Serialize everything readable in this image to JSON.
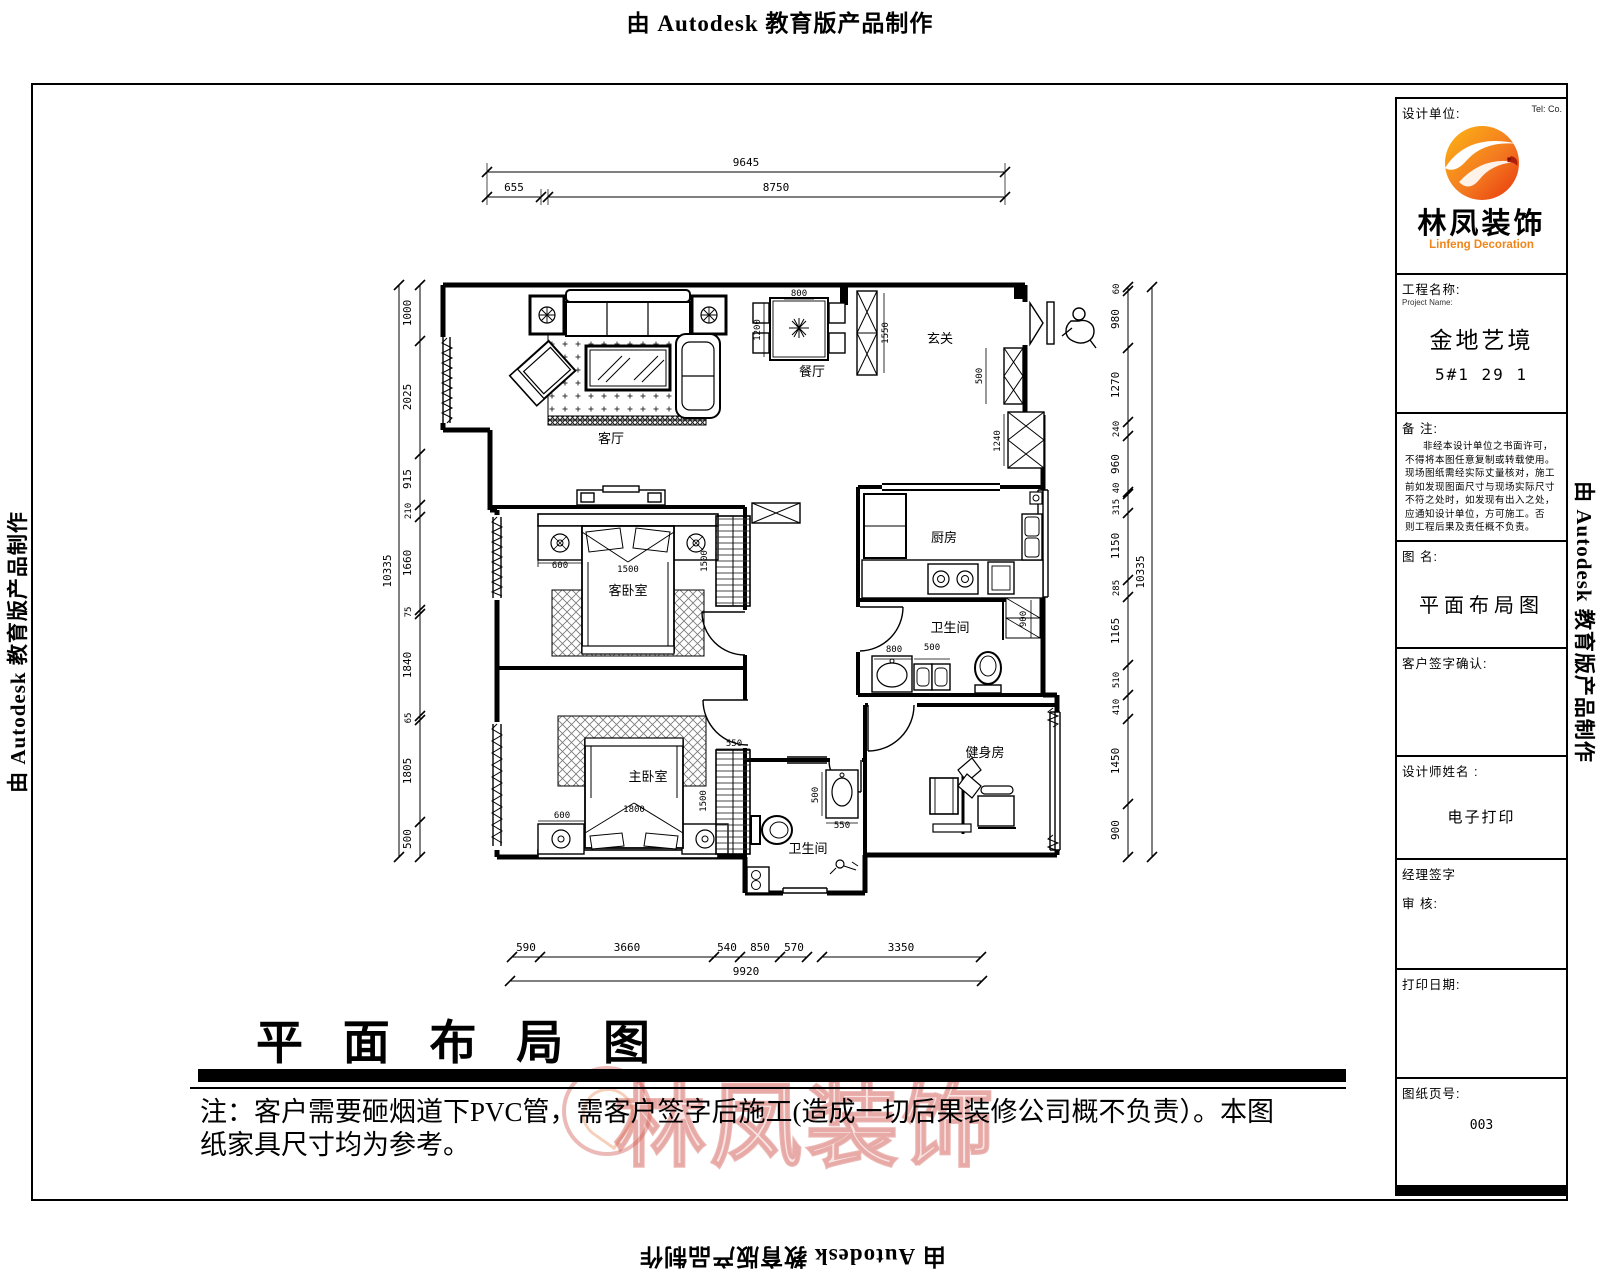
{
  "page": {
    "autodesk_banner": "由 Autodesk 教育版产品制作"
  },
  "title_block": {
    "design_unit_label": "设计单位:",
    "tel_label": "Tel:  Co.",
    "logo_text": "林凤装饰",
    "logo_subtext": "Linfeng Decoration",
    "accent_color": "#f08519",
    "project_label": "工程名称:",
    "project_label_en": "Project Name:",
    "project_name": "金地艺境",
    "project_unit": "5#1 29 1",
    "remark_label": "备  注:",
    "remark_lines": [
      "非经本设计单位之书面许可，",
      "不得将本图任意复制或转载使用。",
      "现场图纸需经实际丈量核对，施工",
      "前如发现图面尺寸与现场实际尺寸",
      "不符之处时，如发现有出入之处，",
      "应通知设计单位，方可施工。否",
      "则工程后果及责任概不负责。"
    ],
    "drawing_name_label": "图  名:",
    "drawing_name": "平面布局图",
    "customer_sign_label": "客户签字确认:",
    "designer_label": "设计师姓名 :",
    "designer_value": "电子打印",
    "manager_sign_label": "经理签字",
    "review_label": "审  核:",
    "print_date_label": "打印日期:",
    "page_no_label": "图纸页号:",
    "page_no": "003"
  },
  "footer": {
    "title": "平 面 布 局 图",
    "note_line1": "注：客户需要砸烟道下PVC管，需客户签字后施工(造成一切后果装修公司概不负责）。本图",
    "note_line2": "纸家具尺寸均为参考。",
    "watermark": "林凤装饰"
  },
  "plan": {
    "rooms": {
      "living": "客厅",
      "dining": "餐厅",
      "entry": "玄关",
      "kitchen": "厨房",
      "bath1": "卫生间",
      "guest": "客卧室",
      "master": "主卧室",
      "bath2": "卫生间",
      "gym": "健身房"
    },
    "dims_top": [
      "9645",
      "655",
      "8750"
    ],
    "dims_bottom": [
      "590",
      "3660",
      "540",
      "850",
      "570",
      "3350"
    ],
    "dim_bottom_total": "9920",
    "dims_left": [
      "1000",
      "2025",
      "915",
      "210",
      "1660",
      "75",
      "1840",
      "65",
      "1805",
      "500"
    ],
    "dim_left_total": "10335",
    "dims_right": [
      "60",
      "980",
      "1270",
      "240",
      "960",
      "40",
      "315",
      "1150",
      "285",
      "1165",
      "510",
      "410",
      "1450",
      "900"
    ],
    "dim_right_total": "10335",
    "inline_dims": {
      "dining_w": "800",
      "dining_d": "1200",
      "entry_cab": "1550",
      "entry_shoe": "500",
      "entry_hall": "1240",
      "guest_ns": "600",
      "guest_bed": "1500",
      "guest_ward": "1500",
      "master_ns": "600",
      "master_bed": "1800",
      "master_ward": "1500",
      "master_ward_w": "550",
      "bath1_a": "800",
      "bath1_b": "500",
      "bath1_c": "900",
      "bath2_a": "500",
      "bath2_b": "550"
    }
  }
}
